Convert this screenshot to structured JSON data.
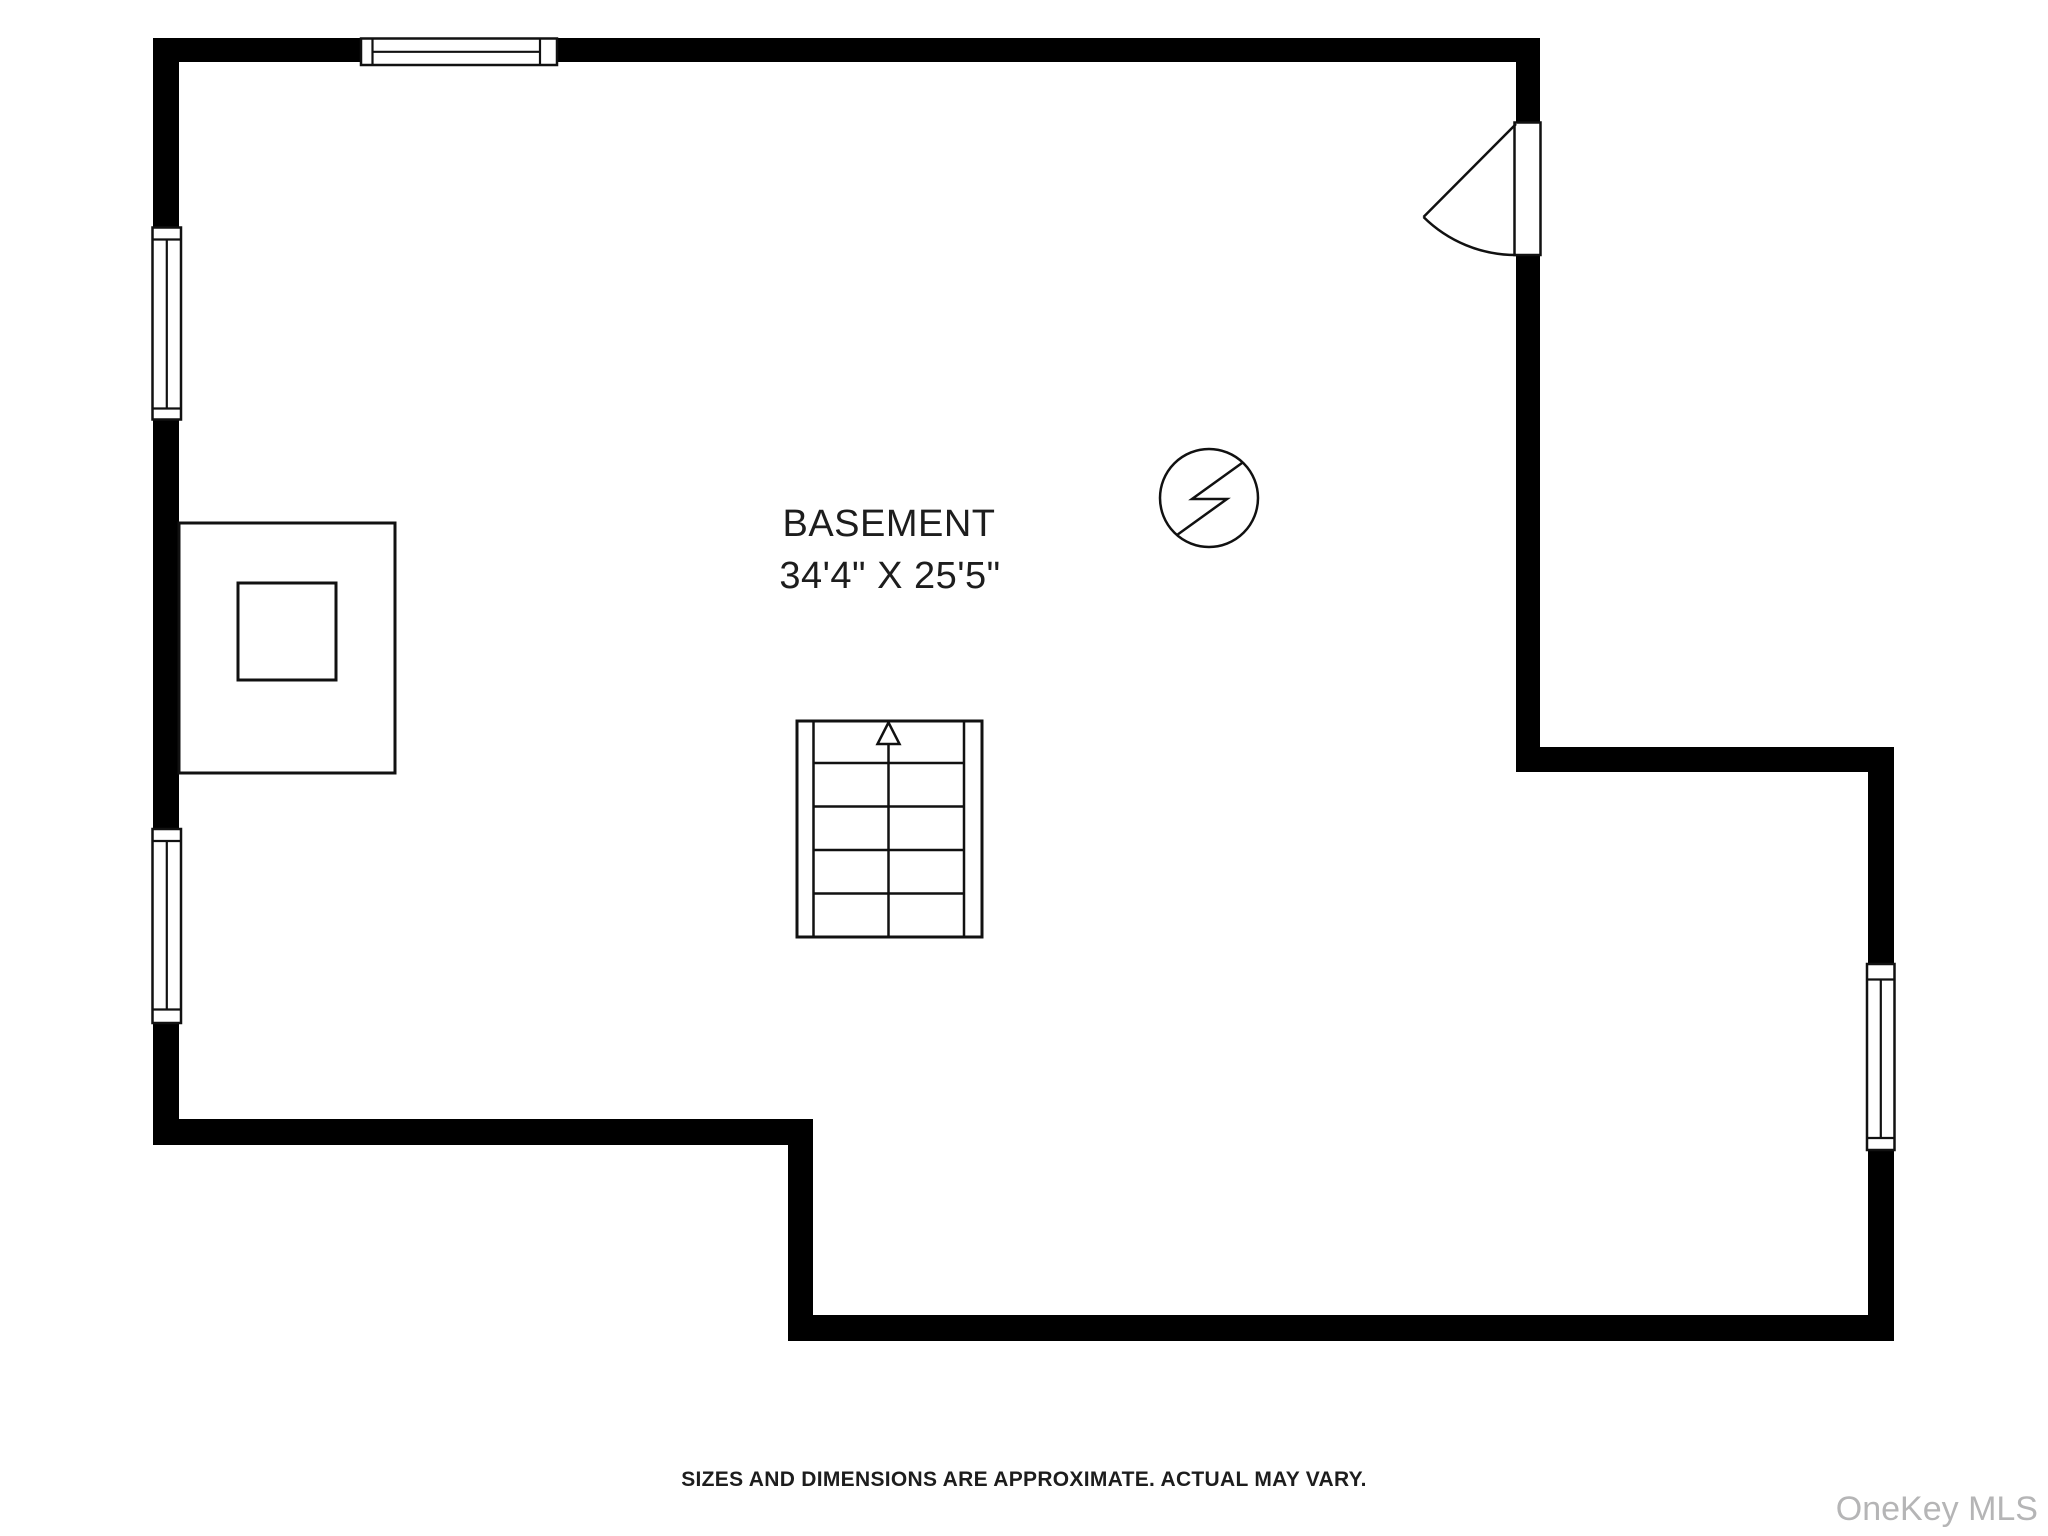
{
  "room": {
    "label": "BASEMENT",
    "dimensions": "34'4\" X 25'5\""
  },
  "symbols": {
    "door": "hinged-door-swing",
    "windows": [
      "top-wall-window",
      "left-wall-window-upper",
      "left-wall-window-lower",
      "right-wall-window"
    ],
    "staircase": "staircase-with-up-arrow",
    "electrical": "electric-panel-symbol",
    "chimney": "chimney-block-with-flue"
  },
  "footer": {
    "disclaimer": "SIZES AND DIMENSIONS ARE APPROXIMATE. ACTUAL MAY VARY."
  },
  "watermark": {
    "text": "OneKey MLS"
  },
  "colors": {
    "wall": "#000000",
    "line": "#111111",
    "text": "#1d1d1d",
    "watermark": "#b5b5b6",
    "background": "#ffffff"
  }
}
